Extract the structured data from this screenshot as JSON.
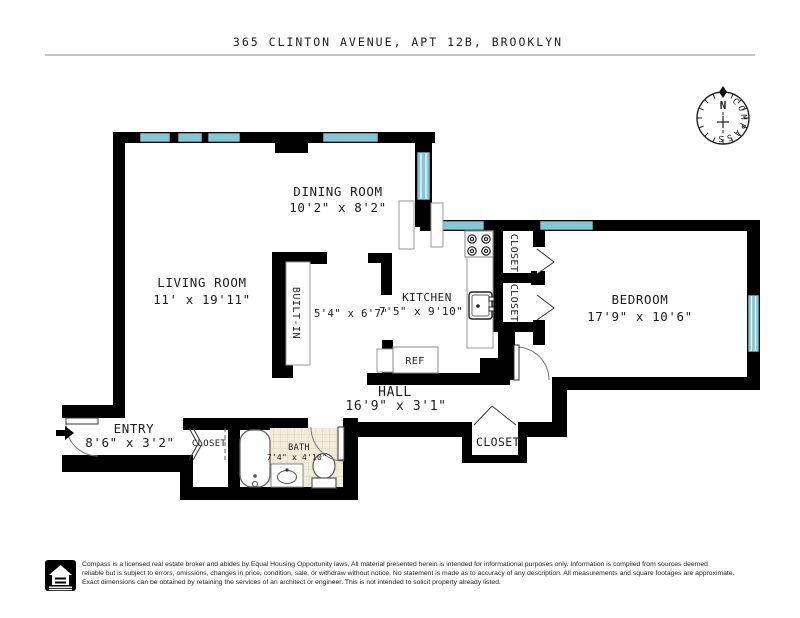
{
  "title": "365 CLINTON AVENUE, APT 12B, BROOKLYN",
  "compass": {
    "north_label": "N",
    "label": "COMPASS"
  },
  "rooms": {
    "dining": {
      "name": "DINING ROOM",
      "dims": "10'2\" x 8'2\""
    },
    "living": {
      "name": "LIVING ROOM",
      "dims": "11' x 19'11\""
    },
    "builtin": {
      "name": "BUILT-IN"
    },
    "foyer": {
      "dims": "5'4\" x 6'7\""
    },
    "kitchen": {
      "name": "KITCHEN",
      "dims": "7'5\" x 9'10\""
    },
    "bedroom": {
      "name": "BEDROOM",
      "dims": "17'9\" x 10'6\""
    },
    "hall": {
      "name": "HALL",
      "dims": "16'9\" x 3'1\""
    },
    "entry": {
      "name": "ENTRY",
      "dims": "8'6\" x 3'2\""
    },
    "bath": {
      "name": "BATH",
      "dims": "7'4\" x 4'10\""
    },
    "closet_upper": "CLOSET",
    "closet_lower": "CLOSET",
    "closet_entry": "CLOSET",
    "closet_hall": "CLOSET",
    "ref": "REF"
  },
  "colors": {
    "wall": "#000000",
    "window": "#84c7d7",
    "north": "#c52727",
    "bath_tile": "#f2ecd9"
  },
  "footer": {
    "line1": "Compass is a licensed real estate broker and abides by Equal Housing Opportunity laws. All material presented herein is intended for informational purposes only. Information is compiled from sources deemed",
    "line2": "reliable but is subject to errors, omissions, changes in price, condition, sale, or withdraw without notice. No statement is made as to accuracy of any description. All measurements and square footages are approximate.",
    "line3": "Exact dimensions can be obtained by retaining the services of an architect or engineer. This is not intended to solicit property already listed."
  }
}
